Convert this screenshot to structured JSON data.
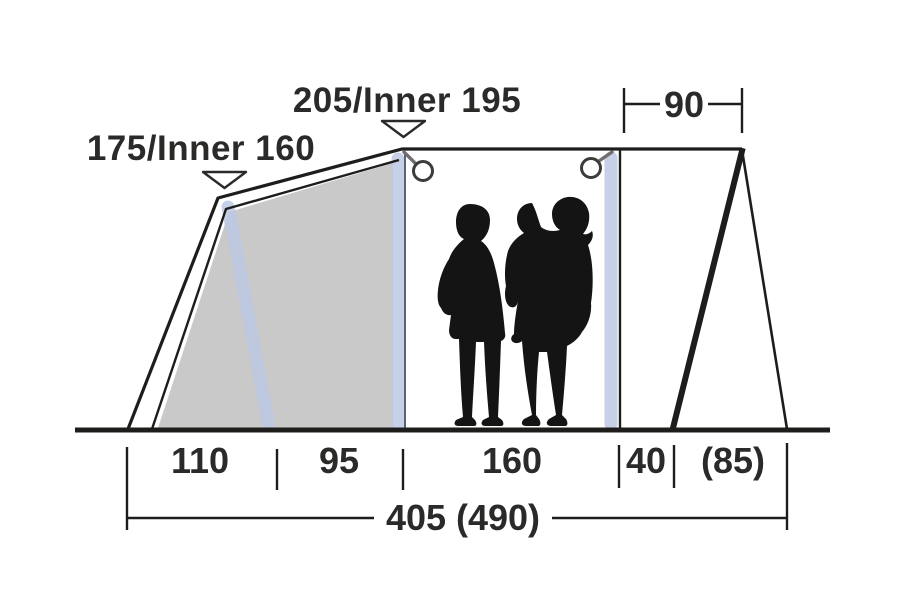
{
  "diagram": {
    "type": "tent-side-profile-dimension-diagram",
    "heights": {
      "front": "175/Inner 160",
      "main": "205/Inner 195"
    },
    "top_width": "90",
    "floor_segments": [
      "110",
      "95",
      "160",
      "40",
      "(85)"
    ],
    "total_length": "405 (490)",
    "colors": {
      "line": "#1d1d1b",
      "text": "#2b2a29",
      "fill": "#c9c9ca",
      "pole": "#bcc8e2",
      "pole-edge": "#5c6272",
      "silhouette": "#141414",
      "background": "#ffffff"
    }
  }
}
